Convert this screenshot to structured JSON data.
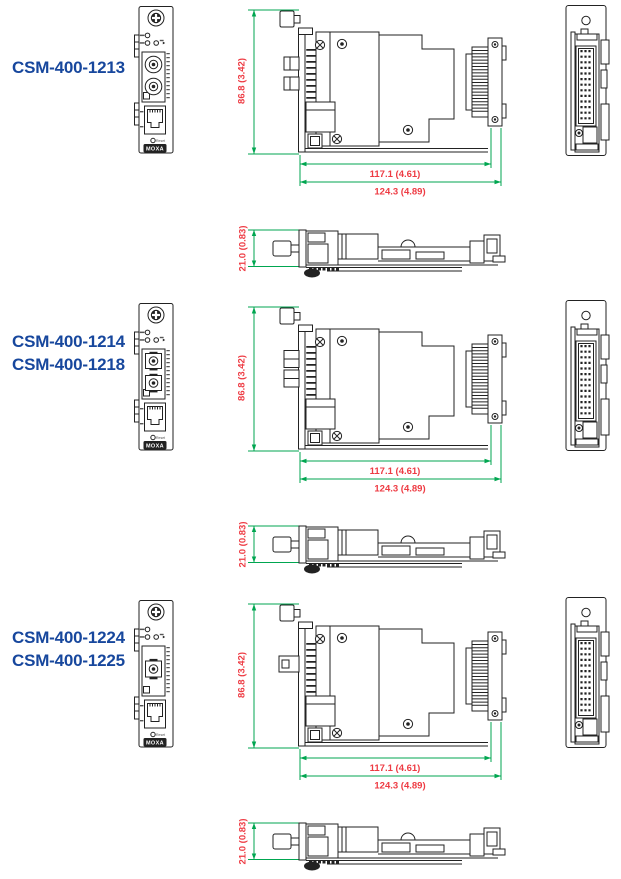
{
  "page": {
    "background": "#ffffff"
  },
  "colors": {
    "model_label_blue": "#17479d",
    "dimension_text_red": "#ee3b43",
    "dimension_line_green": "#00a650",
    "drawing_line": "#222222"
  },
  "groups": [
    {
      "models": [
        "CSM-400-1213"
      ],
      "fiber_connector": "st-duplex",
      "panel": {
        "brand": "MOXA",
        "reset": "Reset"
      },
      "dims": {
        "height": "86.8 (3.42)",
        "body_length": "117.1 (4.61)",
        "total_length": "124.3 (4.89)",
        "depth": "21.0 (0.83)"
      }
    },
    {
      "models": [
        "CSM-400-1214",
        "CSM-400-1218"
      ],
      "fiber_connector": "sc-duplex",
      "panel": {
        "brand": "MOXA",
        "reset": "Reset"
      },
      "dims": {
        "height": "86.8 (3.42)",
        "body_length": "117.1 (4.61)",
        "total_length": "124.3 (4.89)",
        "depth": "21.0 (0.83)"
      }
    },
    {
      "models": [
        "CSM-400-1224",
        "CSM-400-1225"
      ],
      "fiber_connector": "sc-simplex",
      "panel": {
        "brand": "MOXA",
        "reset": "Reset"
      },
      "dims": {
        "height": "86.8 (3.42)",
        "body_length": "117.1 (4.61)",
        "total_length": "124.3 (4.89)",
        "depth": "21.0 (0.83)"
      }
    }
  ]
}
